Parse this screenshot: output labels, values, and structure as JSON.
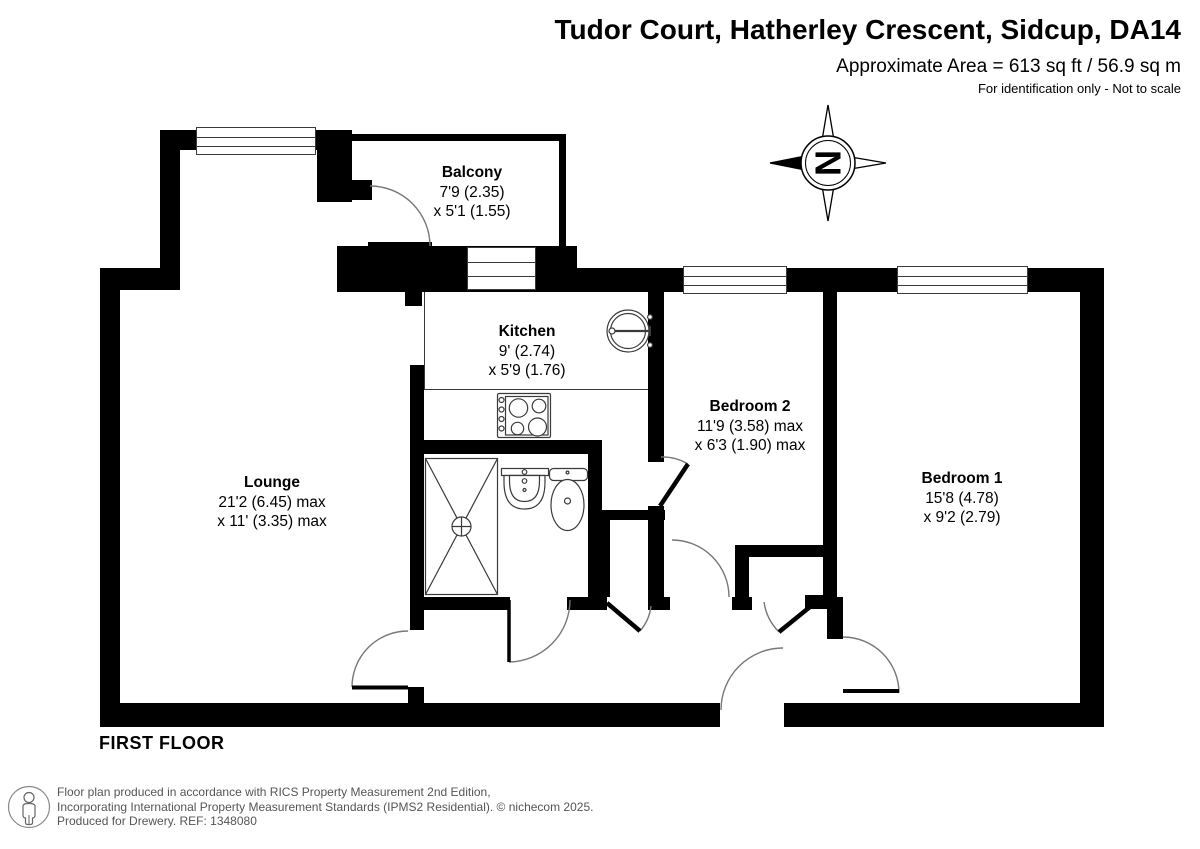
{
  "header": {
    "title": "Tudor Court, Hatherley Crescent, Sidcup, DA14",
    "area_line": "Approximate Area = 613 sq ft / 56.9 sq m",
    "disclaimer": "For identification only - Not to scale"
  },
  "plan": {
    "floor_label": "FIRST FLOOR",
    "compass_letter": "N",
    "rooms": [
      {
        "name": "Balcony",
        "size1": "7'9 (2.35)",
        "size2": "x 5'1 (1.55)"
      },
      {
        "name": "Kitchen",
        "size1": "9' (2.74)",
        "size2": "x 5'9 (1.76)"
      },
      {
        "name": "Lounge",
        "size1": "21'2 (6.45) max",
        "size2": "x 11' (3.35) max"
      },
      {
        "name": "Bedroom 2",
        "size1": "11'9 (3.58) max",
        "size2": "x 6'3 (1.90) max"
      },
      {
        "name": "Bedroom 1",
        "size1": "15'8 (4.78)",
        "size2": "x 9'2 (2.79)"
      }
    ],
    "fixtures": [
      "shower-tray",
      "washbasin",
      "toilet",
      "hob",
      "kitchen-sink"
    ]
  },
  "footer": {
    "line1": "Floor plan produced in accordance with RICS Property Measurement 2nd Edition,",
    "line2": "Incorporating International Property Measurement Standards (IPMS2 Residential).   © nichecom 2025.",
    "line3": "Produced for Drewery.   REF: 1348080"
  },
  "colors": {
    "wall": "#000000",
    "fixture_line": "#3a3a3a",
    "door_arc": "#777777",
    "footer_text": "#555555"
  }
}
